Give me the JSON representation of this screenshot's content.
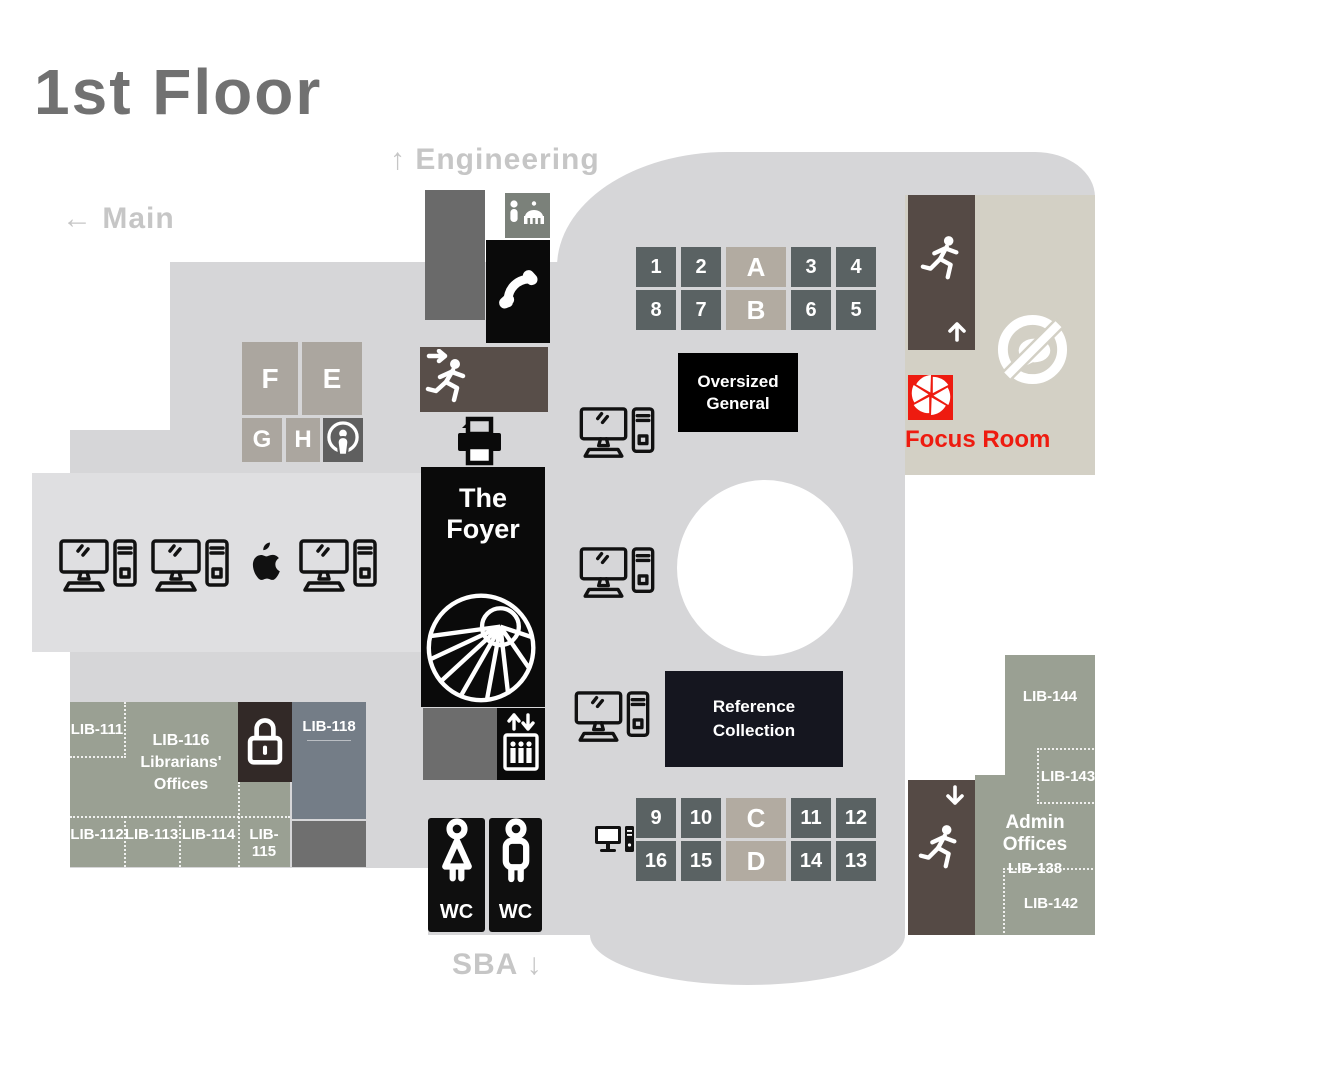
{
  "title": "1st Floor",
  "directions": {
    "engineering": {
      "arrow": "↑",
      "label": "Engineering"
    },
    "main": {
      "arrow": "←",
      "label": "Main"
    },
    "sba": {
      "label": "SBA",
      "arrow": "↓"
    }
  },
  "shelves_top": {
    "row1": [
      "1",
      "2",
      "A",
      "3",
      "4"
    ],
    "row2": [
      "8",
      "7",
      "B",
      "6",
      "5"
    ]
  },
  "shelves_bottom": {
    "row1": [
      "9",
      "10",
      "C",
      "11",
      "12"
    ],
    "row2": [
      "16",
      "15",
      "D",
      "14",
      "13"
    ]
  },
  "collections": {
    "oversized": {
      "line1": "Oversized",
      "line2": "General"
    },
    "reference": {
      "line1": "Reference",
      "line2": "Collection"
    }
  },
  "foyer": {
    "line1": "The",
    "line2": "Foyer"
  },
  "stack_letters": {
    "f": "F",
    "e": "E",
    "g": "G",
    "h": "H"
  },
  "offices": {
    "lib111": "LIB-111",
    "lib112": "LIB-112",
    "lib113": "LIB-113",
    "lib114": "LIB-114",
    "lib115": "LIB-115",
    "lib116": {
      "line1": "LIB-116",
      "line2": "Librarians'",
      "line3": "Offices"
    },
    "lib118": "LIB-118"
  },
  "admin": {
    "title": "Admin Offices",
    "room": "LIB-138",
    "lib142": "LIB-142",
    "lib143": "LIB-143",
    "lib144": "LIB-144"
  },
  "focus_room": {
    "label": "Focus Room"
  },
  "restrooms": {
    "women_label": "WC",
    "men_label": "WC"
  },
  "icons": {
    "prayer_person": "standing-person",
    "prayer_mosque": "mosque",
    "phone": "telephone-handset",
    "exit_runner": "running-person-exit",
    "printer": "printer",
    "spiral_stairs": "spiral-staircase",
    "podcast": "podcast-studio",
    "computer": "desktop-computer-workstation",
    "apple": "apple-mac-workstation",
    "lock": "padlock-restricted",
    "elevator": "elevator",
    "wc_female": "female-figure",
    "wc_male": "male-figure",
    "no_talking": "quiet-zone-no-talking",
    "aperture": "camera-aperture"
  },
  "colors": {
    "floor": "#d6d6d8",
    "floor_light": "#dfdfe1",
    "beige": "#d3d0c5",
    "office_green": "#9aa093",
    "shelf_dark": "#5a6263",
    "shelf_tan": "#b2aba1",
    "exit_brown": "#564c47",
    "slate_room": "#747d87",
    "reference_navy": "#15161f",
    "focus_red": "#ee1b10",
    "direction_gray": "#c6c6c6",
    "title_gray": "#717171"
  }
}
